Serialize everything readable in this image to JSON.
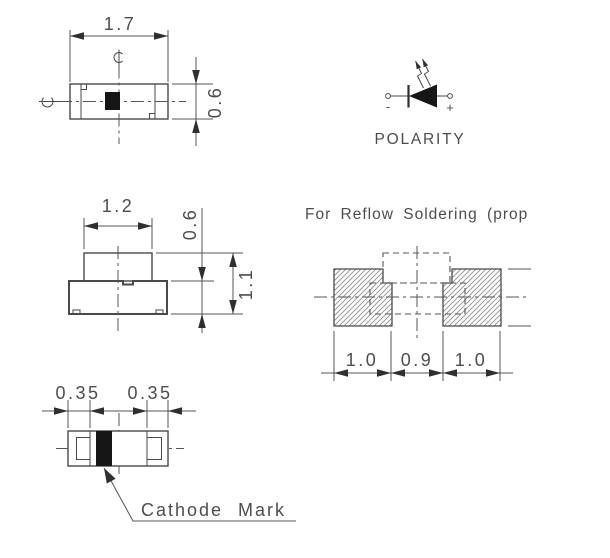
{
  "colors": {
    "background": "#ffffff",
    "outline": "#4a4a4a",
    "dimension": "#555555",
    "mark_fill": "#161616",
    "hatch": "#909090"
  },
  "top_view": {
    "dim_width": "1.7",
    "dim_height": "0.6"
  },
  "polarity": {
    "label": "POLARITY",
    "negative_sign": "-",
    "positive_sign": "+"
  },
  "side_view": {
    "dim_width": "1.2",
    "dim_base_height": "0.6",
    "dim_total_height": "1.1"
  },
  "reflow_pattern": {
    "title": "For Reflow Soldering (prop",
    "dim_left_pad": "1.0",
    "dim_gap": "0.9",
    "dim_right_pad": "1.0"
  },
  "bottom_view": {
    "dim_left_terminal": "0.35",
    "dim_right_terminal": "0.35",
    "cathode_mark_label": "Cathode Mark"
  }
}
